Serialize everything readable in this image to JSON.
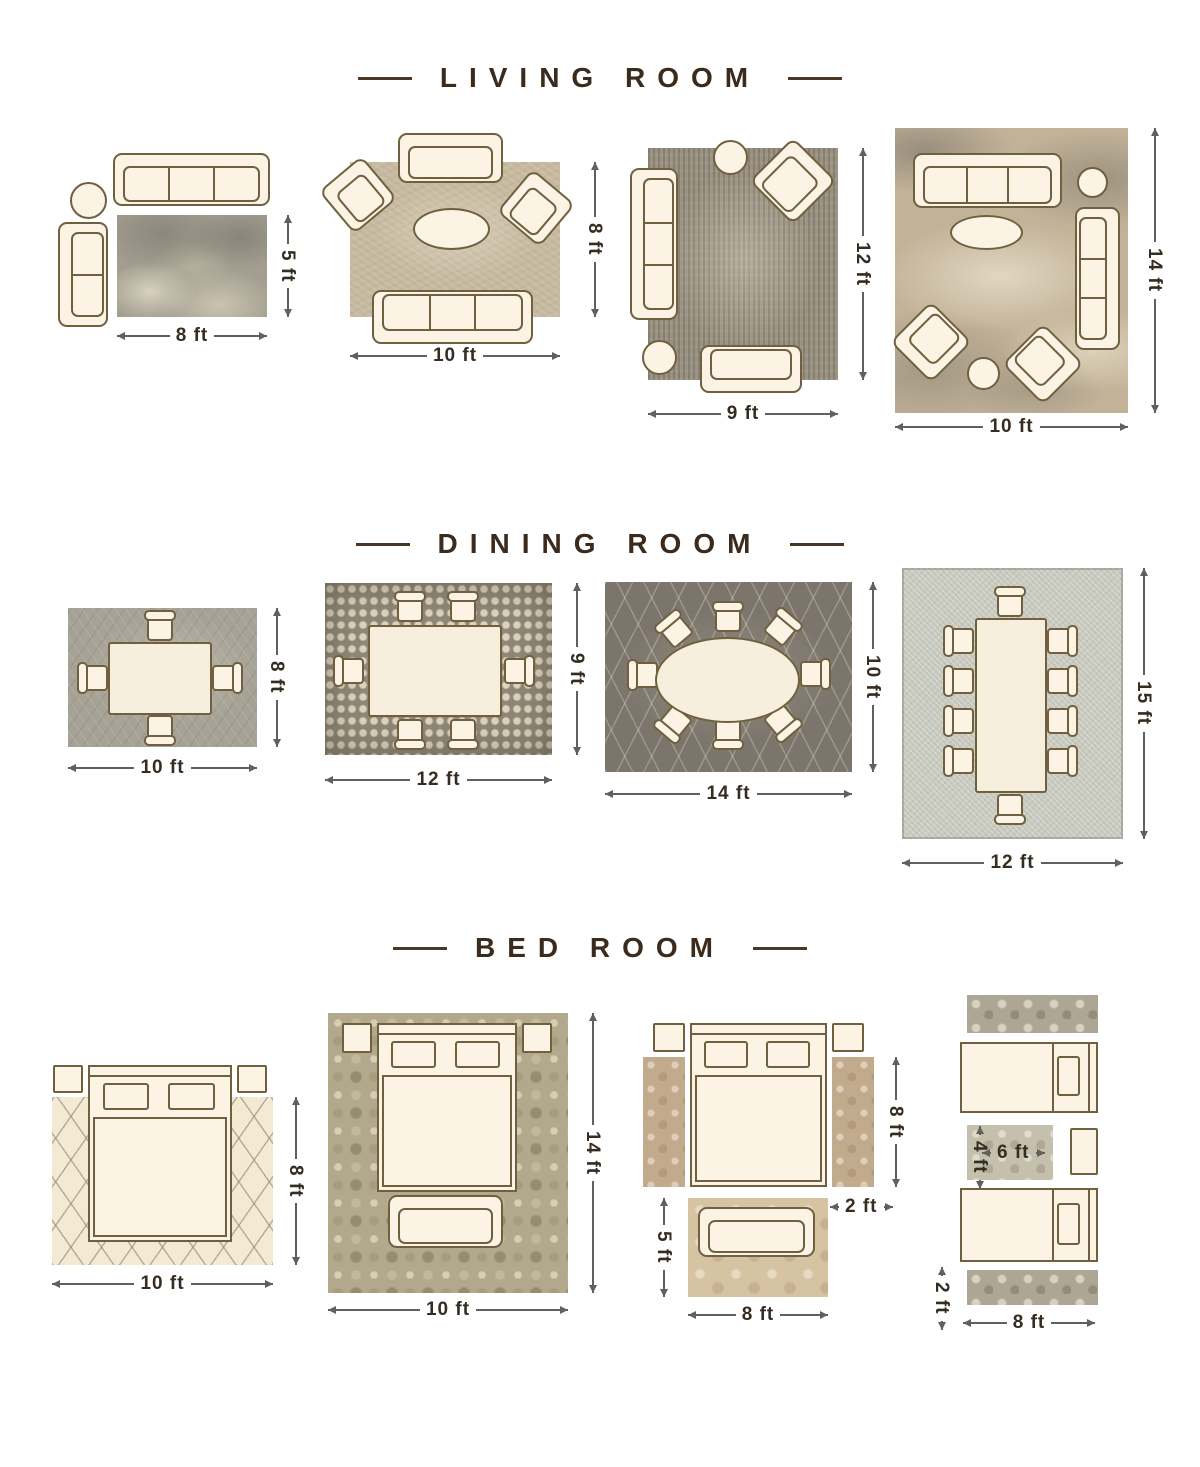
{
  "page": {
    "background": "#ffffff"
  },
  "colors": {
    "title_text": "#3b2b1d",
    "dimension_text": "#352c22",
    "dimension_line": "#62605a",
    "furniture_outline": "#70603f",
    "furniture_fill": "#fbf3e4"
  },
  "sections": [
    {
      "id": "living-room",
      "title": "LIVING ROOM",
      "layouts": [
        {
          "name": "rug-8x5",
          "width_label": "8 ft",
          "height_label": "5 ft"
        },
        {
          "name": "rug-10x8",
          "width_label": "10 ft",
          "height_label": "8 ft"
        },
        {
          "name": "rug-9x12",
          "width_label": "9 ft",
          "height_label": "12 ft"
        },
        {
          "name": "rug-10x14",
          "width_label": "10 ft",
          "height_label": "14 ft"
        }
      ]
    },
    {
      "id": "dining-room",
      "title": "DINING ROOM",
      "layouts": [
        {
          "name": "rug-10x8",
          "width_label": "10 ft",
          "height_label": "8 ft"
        },
        {
          "name": "rug-12x9",
          "width_label": "12 ft",
          "height_label": "9 ft"
        },
        {
          "name": "rug-14x10",
          "width_label": "14 ft",
          "height_label": "10 ft"
        },
        {
          "name": "rug-12x15",
          "width_label": "12 ft",
          "height_label": "15 ft"
        }
      ]
    },
    {
      "id": "bed-room",
      "title": "BED ROOM",
      "layouts": [
        {
          "name": "rug-10x8",
          "width_label": "10 ft",
          "height_label": "8 ft"
        },
        {
          "name": "rug-10x14",
          "width_label": "10 ft",
          "height_label": "14 ft"
        },
        {
          "name": "runners-with-foot-rug",
          "width_label": "8 ft",
          "height_label": "5 ft",
          "runner_width_label": "2 ft",
          "runner_height_label": "8 ft"
        },
        {
          "name": "twin-beds-with-runners",
          "width_label": "8 ft",
          "runner_width_label": "2 ft",
          "between_rug_width_label": "6 ft",
          "between_rug_height_label": "4 ft"
        }
      ]
    }
  ]
}
